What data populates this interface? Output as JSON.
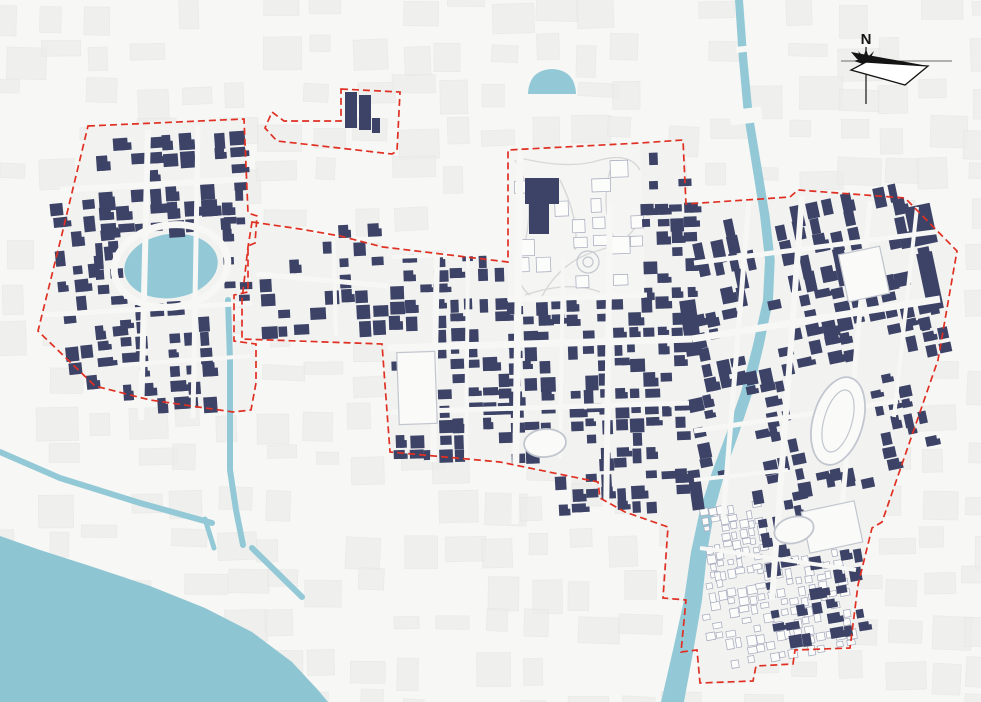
{
  "compass": {
    "label": "N"
  },
  "colors": {
    "background": "#f7f7f5",
    "plate": "#f2f2f0",
    "park": "#f5f5f3",
    "texture": "#ededeb",
    "texture_edge": "#e5e5e3",
    "water": "#93c9d6",
    "sea": "#8ec5d3",
    "building": "#3d4366",
    "outline_building": "#a3a8bc",
    "outline_building_light": "#c9ccd6",
    "boundary_red": "#e03023",
    "park_path": "#d8d8da",
    "landmark_stroke": "#c2c6cf",
    "landmark_fill": "#fafaf9",
    "compass_ink": "#141414"
  },
  "boundaries": [
    {
      "name": "left-district",
      "path": "M 88 126 L 244 119 L 248 213 L 257 216 L 255 243 L 248 246 L 248 292 L 234 295 L 234 341 L 256 344 L 256 383 L 251 410 L 233 412 L 150 400 L 95 386 L 38 331 L 62 234 Z"
    },
    {
      "name": "detached-parcel",
      "path": "M 341 89 L 400 92 L 397 151 L 392 154 L 277 141 L 265 128 L 272 112 L 284 121 L 341 121 Z"
    },
    {
      "name": "main-area",
      "path": "M 252 222 L 300 229 L 340 236 L 383 247 L 508 262 L 508 150 L 640 143 L 683 140 L 686 204 L 790 197 L 798 190 L 905 198 L 957 251 L 938 360 L 882 522 L 872 528 L 858 585 L 850 648 L 795 650 L 793 664 L 756 666 L 753 681 L 700 683 L 697 650 L 681 652 L 686 600 L 663 598 L 668 527 L 625 512 L 600 498 L 598 482 L 500 462 L 390 452 L 382 344 L 242 339 L 242 300 L 248 247 Z"
    }
  ],
  "plates": [
    "M 88 126 L 244 119 L 248 213 L 257 216 L 255 243 L 248 246 L 248 292 L 234 295 L 234 341 L 256 344 L 256 383 L 251 410 L 233 412 L 150 400 L 95 386 L 38 331 L 62 234 Z",
    "M 252 222 L 383 247 L 508 262 L 508 150 L 640 143 L 683 140 L 686 204 L 790 197 L 798 190 L 905 198 L 957 251 L 938 360 L 882 522 L 872 528 L 858 585 L 850 648 L 795 650 L 793 664 L 756 666 L 753 681 L 700 683 L 697 650 L 681 652 L 686 600 L 663 598 L 668 527 L 625 512 L 600 498 L 598 482 L 500 462 L 390 452 L 382 344 L 242 339 L 242 300 L 248 247 Z"
  ],
  "park_polygon": "M 508 150 L 640 143 L 646 298 L 508 300 Z",
  "water": {
    "sea_path": "M 0 536 L 40 550 L 90 566 L 150 586 L 205 608 L 252 632 L 292 662 L 318 690 L 328 702 L 0 702 Z",
    "river_left": [
      [
        735,
        0
      ],
      [
        739,
        60
      ],
      [
        744,
        115
      ],
      [
        752,
        165
      ],
      [
        760,
        215
      ],
      [
        765,
        260
      ],
      [
        763,
        300
      ],
      [
        753,
        345
      ],
      [
        741,
        392
      ],
      [
        727,
        432
      ],
      [
        712,
        472
      ],
      [
        700,
        510
      ],
      [
        691,
        552
      ],
      [
        684,
        600
      ],
      [
        673,
        650
      ],
      [
        661,
        702
      ]
    ],
    "river_width": [
      [
        0,
        8
      ],
      [
        300,
        10
      ],
      [
        470,
        13
      ],
      [
        600,
        18
      ],
      [
        702,
        23
      ]
    ],
    "canals": [
      {
        "d": "M 0 452 L 60 478 L 140 503 L 212 523",
        "w": 6
      },
      {
        "d": "M 205 519 L 214 548",
        "w": 5
      },
      {
        "d": "M 252 548 L 302 597",
        "w": 6
      },
      {
        "d": "M 228 300 L 230 360 L 230 470 L 236 510 L 243 545",
        "w": 6
      }
    ],
    "lake": {
      "cx": 171,
      "cy": 266,
      "rx": 47,
      "ry": 32,
      "rot": -8
    },
    "pond_path": "M 528 94 Q 529 70 552 69 Q 575 70 576 94 Z"
  },
  "park_paths": [
    "M 515 160 Q 540 200 520 260 Q 515 285 530 295",
    "M 520 158 Q 570 170 600 160 Q 630 152 640 170",
    "M 540 300 Q 560 260 600 250 Q 635 240 640 215",
    "M 560 180 Q 580 220 575 250",
    "M 610 170 Q 600 210 615 240",
    "M 525 295 Q 570 280 600 292"
  ],
  "park_circles": [
    {
      "cx": 588,
      "cy": 262,
      "r": 11
    },
    {
      "cx": 588,
      "cy": 262,
      "r": 5
    }
  ],
  "zones": [
    {
      "name": "left-north",
      "x": 96,
      "y": 134,
      "w": 148,
      "h": 94,
      "cell": 17,
      "density": 0.62,
      "angle": -4
    },
    {
      "name": "left-west",
      "x": 58,
      "y": 198,
      "w": 64,
      "h": 182,
      "cell": 16,
      "density": 0.42,
      "angle": -6
    },
    {
      "name": "left-south",
      "x": 120,
      "y": 300,
      "w": 124,
      "h": 110,
      "cell": 16,
      "density": 0.55,
      "angle": -4
    },
    {
      "name": "left-lakeside",
      "x": 94,
      "y": 226,
      "w": 28,
      "h": 76,
      "cell": 14,
      "density": 0.5,
      "angle": -4
    },
    {
      "name": "left-east",
      "x": 222,
      "y": 150,
      "w": 26,
      "h": 150,
      "cell": 13,
      "density": 0.5,
      "angle": -2
    },
    {
      "name": "corridor",
      "x": 258,
      "y": 226,
      "w": 126,
      "h": 108,
      "cell": 16,
      "density": 0.4,
      "angle": -3
    },
    {
      "name": "old-town-west",
      "x": 686,
      "y": 505,
      "w": 78,
      "h": 72,
      "cell": 9,
      "density": 0.8,
      "angle": -10,
      "style": "outline"
    },
    {
      "name": "old-town-south",
      "x": 700,
      "y": 560,
      "w": 152,
      "h": 102,
      "cell": 10,
      "density": 0.7,
      "angle": -10,
      "style": "outline"
    },
    {
      "name": "park-parcels",
      "x": 515,
      "y": 160,
      "w": 125,
      "h": 135,
      "cell": 19,
      "density": 0.28,
      "angle": -2,
      "style": "outline"
    },
    {
      "name": "central-west",
      "x": 390,
      "y": 253,
      "w": 118,
      "h": 202,
      "cell": 15,
      "density": 0.68,
      "angle": -2
    },
    {
      "name": "central-east",
      "x": 508,
      "y": 298,
      "w": 180,
      "h": 158,
      "cell": 15,
      "density": 0.68,
      "angle": -2
    },
    {
      "name": "park-east-strip",
      "x": 642,
      "y": 203,
      "w": 48,
      "h": 98,
      "cell": 14,
      "density": 0.6,
      "angle": -2
    },
    {
      "name": "park-north-pocket",
      "x": 648,
      "y": 150,
      "w": 38,
      "h": 50,
      "cell": 14,
      "density": 0.35,
      "angle": -2
    },
    {
      "name": "central-south",
      "x": 555,
      "y": 456,
      "w": 133,
      "h": 62,
      "cell": 15,
      "density": 0.55,
      "angle": -3
    },
    {
      "name": "right-north",
      "x": 694,
      "y": 203,
      "w": 214,
      "h": 88,
      "cell": 17,
      "density": 0.66,
      "angle": -12,
      "elong": "y"
    },
    {
      "name": "right-northeast",
      "x": 898,
      "y": 232,
      "w": 44,
      "h": 118,
      "cell": 14,
      "density": 0.5,
      "angle": -12
    },
    {
      "name": "right-mid",
      "x": 694,
      "y": 291,
      "w": 240,
      "h": 82,
      "cell": 16,
      "density": 0.66,
      "angle": -12
    },
    {
      "name": "right-southwest",
      "x": 694,
      "y": 373,
      "w": 96,
      "h": 118,
      "cell": 15,
      "density": 0.6,
      "angle": -12
    },
    {
      "name": "right-southeast",
      "x": 862,
      "y": 373,
      "w": 64,
      "h": 96,
      "cell": 14,
      "density": 0.5,
      "angle": -12
    },
    {
      "name": "right-stadium-south",
      "x": 790,
      "y": 470,
      "w": 80,
      "h": 46,
      "cell": 14,
      "density": 0.45,
      "angle": -12
    },
    {
      "name": "south-pocket",
      "x": 757,
      "y": 480,
      "w": 100,
      "h": 92,
      "cell": 15,
      "density": 0.4,
      "angle": -10
    },
    {
      "name": "south-east-pocket",
      "x": 768,
      "y": 574,
      "w": 90,
      "h": 66,
      "cell": 14,
      "density": 0.5,
      "angle": -10
    }
  ],
  "skip_rects": [
    [
      120,
      230,
      104,
      74
    ],
    [
      220,
      298,
      20,
      252
    ],
    [
      806,
      372,
      66,
      100
    ],
    [
      396,
      348,
      44,
      80
    ],
    [
      800,
      502,
      64,
      50
    ],
    [
      533,
      427,
      48,
      36
    ],
    [
      524,
      64,
      56,
      36
    ],
    [
      752,
      195,
      28,
      110
    ],
    [
      748,
      291,
      30,
      86
    ],
    [
      716,
      373,
      34,
      130
    ],
    [
      662,
      498,
      44,
      175
    ]
  ],
  "extra_buildings": [
    [
      345,
      92,
      12,
      36,
      0
    ],
    [
      359,
      95,
      12,
      35,
      0
    ],
    [
      372,
      118,
      8,
      15,
      0
    ],
    [
      525,
      178,
      34,
      26,
      0
    ],
    [
      529,
      204,
      20,
      30,
      0
    ],
    [
      683,
      300,
      16,
      56,
      -8
    ],
    [
      690,
      470,
      12,
      40,
      -8
    ],
    [
      908,
      205,
      26,
      40,
      -12
    ],
    [
      922,
      252,
      16,
      58,
      -12
    ]
  ],
  "streets": [
    [
      148,
      130,
      141,
      420,
      6
    ],
    [
      198,
      126,
      193,
      418,
      5
    ],
    [
      60,
      190,
      247,
      179,
      6
    ],
    [
      44,
      315,
      252,
      303,
      5
    ],
    [
      120,
      365,
      250,
      356,
      4
    ],
    [
      256,
      274,
      388,
      286,
      5
    ],
    [
      333,
      228,
      336,
      336,
      4
    ],
    [
      437,
      252,
      433,
      462,
      6
    ],
    [
      520,
      150,
      515,
      524,
      7
    ],
    [
      610,
      202,
      606,
      528,
      6
    ],
    [
      563,
      258,
      560,
      458,
      4
    ],
    [
      388,
      348,
      692,
      339,
      7
    ],
    [
      391,
      412,
      689,
      403,
      5
    ],
    [
      508,
      300,
      647,
      295,
      5
    ],
    [
      392,
      257,
      506,
      253,
      4
    ],
    [
      468,
      252,
      466,
      460,
      4
    ],
    [
      692,
      339,
      940,
      299,
      7
    ],
    [
      694,
      263,
      942,
      231,
      5
    ],
    [
      694,
      431,
      898,
      401,
      5
    ],
    [
      749,
      200,
      723,
      519,
      5
    ],
    [
      802,
      196,
      772,
      600,
      6
    ],
    [
      870,
      201,
      841,
      519,
      5
    ],
    [
      917,
      207,
      894,
      417,
      4
    ],
    [
      694,
      480,
      788,
      470,
      4
    ],
    [
      700,
      548,
      856,
      570,
      4
    ],
    [
      730,
      118,
      762,
      114,
      15
    ],
    [
      736,
      50,
      753,
      48,
      6
    ]
  ],
  "rings": [
    {
      "cx": 171,
      "cy": 266,
      "rx": 57,
      "ry": 41,
      "rot": -8,
      "w": 7
    }
  ],
  "landmarks": {
    "white_buildings": [
      {
        "x": 398,
        "y": 352,
        "w": 38,
        "h": 72,
        "rot": -2
      },
      {
        "x": 805,
        "y": 506,
        "w": 54,
        "h": 42,
        "rot": -12
      },
      {
        "x": 843,
        "y": 250,
        "w": 42,
        "h": 48,
        "rot": -12
      }
    ],
    "ovals": [
      {
        "cx": 838,
        "cy": 421,
        "rx": 25,
        "ry": 45,
        "rot": 16,
        "inner": false
      },
      {
        "cx": 838,
        "cy": 421,
        "rx": 14,
        "ry": 32,
        "rot": 16,
        "inner": true
      },
      {
        "cx": 794,
        "cy": 530,
        "rx": 20,
        "ry": 13,
        "rot": -15,
        "inner": false
      },
      {
        "cx": 545,
        "cy": 443,
        "rx": 21,
        "ry": 14,
        "rot": -5,
        "inner": false
      }
    ]
  },
  "texture": {
    "cols": 23,
    "rows": 18,
    "stepx": 44,
    "stepy": 41
  }
}
